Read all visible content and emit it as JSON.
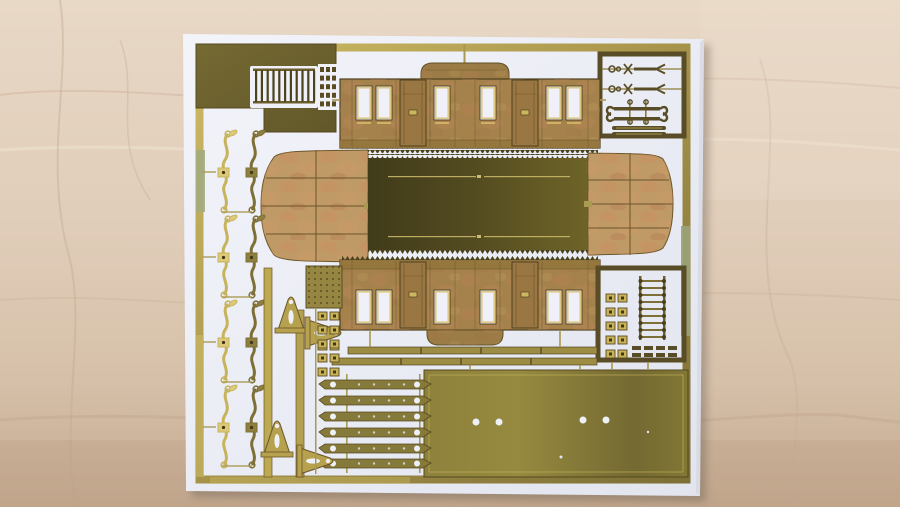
{
  "scene": {
    "type": "photograph",
    "subject": "Brass photo-etched model railway coach kit fret on a white backing card, lying on a light wooden surface",
    "orientation": "landscape",
    "text_visible": "none"
  },
  "colors": {
    "wood_light": "#e7d7c5",
    "wood_dark": "#c6ab92",
    "card_white": "#eef0f8",
    "brass_bright": "#d9c878",
    "brass_gold": "#a6934a",
    "brass_dark_olive": "#584d26",
    "coach_brass": "#a5824c",
    "patina_red": "#c28a5e",
    "roof_dark": "#45401c",
    "plate_olive": "#8d813c",
    "sage_green": "#9fa87d",
    "outline": "#50421e"
  },
  "fret": {
    "parts": [
      "backing-card",
      "fret-outer-frame",
      "ventilation-grille",
      "detail-parts-box-top-right",
      "upper-coach-side",
      "lower-coach-side",
      "center-roof-panel",
      "roof-end-left",
      "roof-end-right",
      "access-ladder",
      "hinge-pairs",
      "queenpost-brackets",
      "brake-lever-sprues",
      "solebar-strips",
      "floor-plate",
      "grab-handle-strips",
      "mesh-plate"
    ],
    "counts": {
      "grille_bars": 11,
      "ladder_rungs": 9,
      "solebar_strips": 6,
      "floor_plate_holes": 4,
      "coach_windows_per_side": 6,
      "coach_doors_per_side": 2,
      "roof_end_panels": 8,
      "hinge_pairs": 7,
      "brake_lever_parts": 8
    }
  }
}
